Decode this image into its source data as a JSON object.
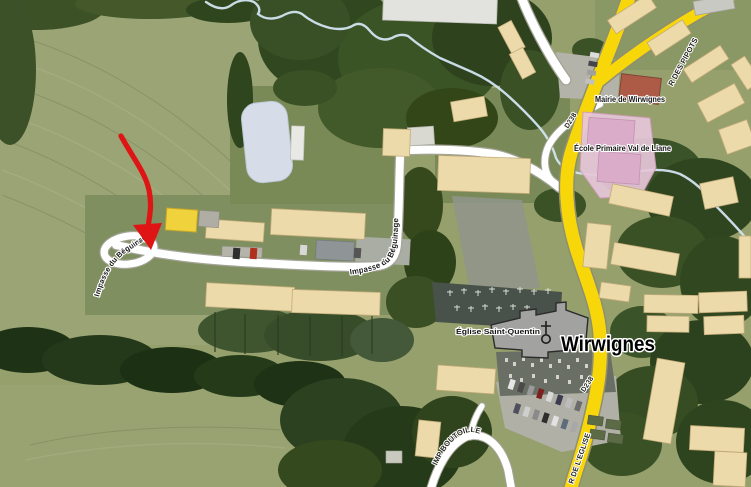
{
  "map": {
    "type": "aerial-satellite-map",
    "town": "Wirwignes",
    "poi_labels": {
      "mairie": "Mairie de Wirwignes",
      "ecole": "École Primaire Val de Liane",
      "eglise": "Église Saint-Quentin"
    },
    "road_labels": {
      "d238_north": "D238",
      "d238_south": "D238",
      "r_de_leglise": "R DE L'EGLISE",
      "r_des_pipots": "R DES PIPOTS",
      "imp_boutoille": "IMP BOUTOILLE",
      "impasse_beguinage_center": "Impasse du Béguinage",
      "impasse_beguinage_west": "Impasse du Béguinage"
    },
    "icons": {
      "church": "church-cross-icon",
      "arrow": "red-location-arrow"
    },
    "colors": {
      "road_yellow": "#f8d70a",
      "road_white": "#ffffff",
      "school_zone_pink": "#e7c7d9",
      "school_building_pink": "#dbacc9",
      "mairie_red": "#ad5a47",
      "building_beige": "#ecdaab",
      "highlight_building_yellow": "#f0d23c",
      "field_green": "#96a06d",
      "tree_green": "#31471f",
      "water_blue": "#d2e4f0",
      "church_gray": "#a2a2a0",
      "annotation_arrow_red": "#df1414"
    }
  }
}
